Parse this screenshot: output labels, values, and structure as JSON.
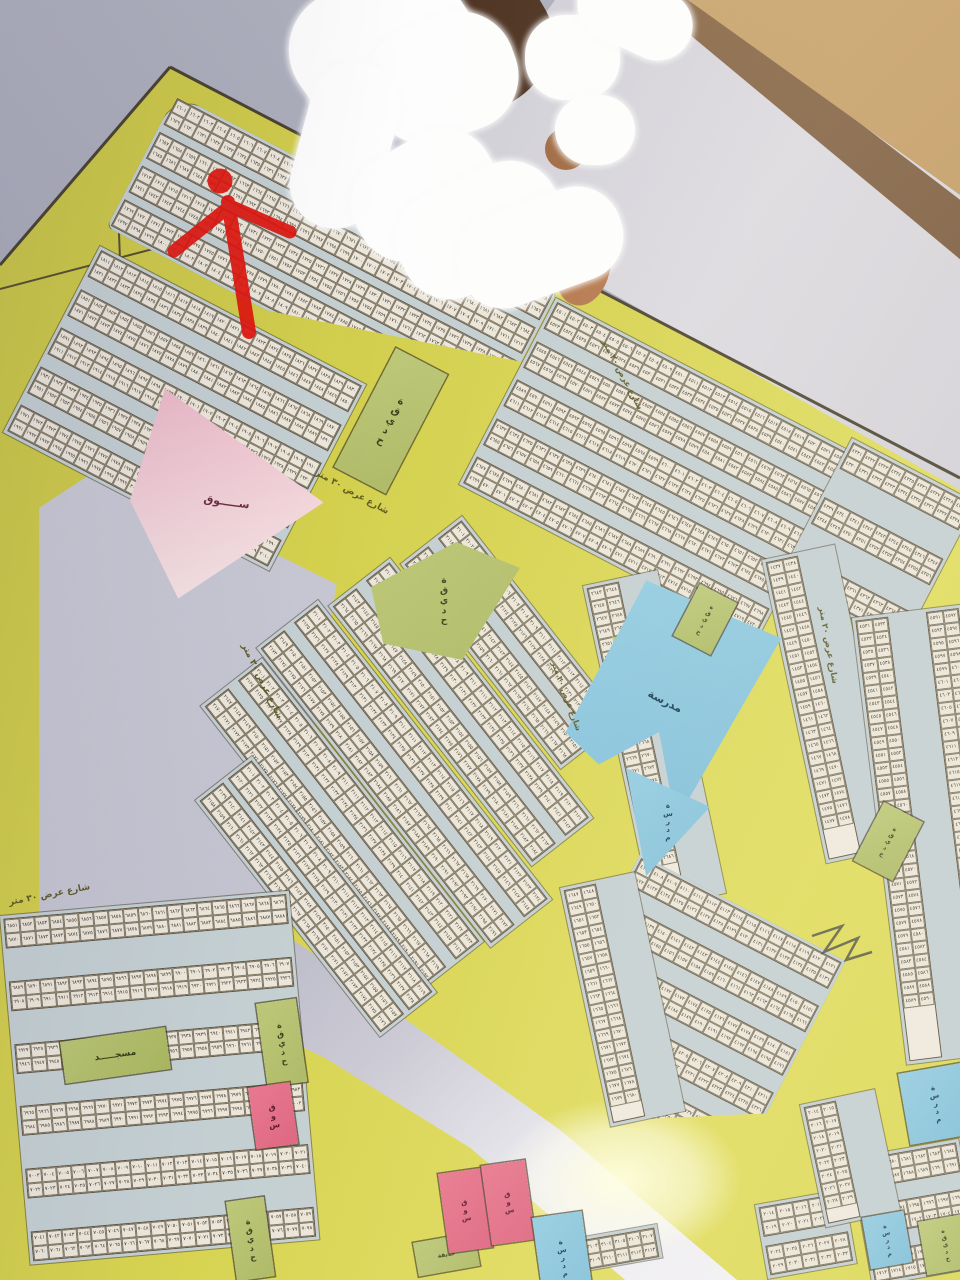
{
  "photo_subject": "wall-mounted land subdivision plot map",
  "arabic_digits": "٠١٢٣٤٥٦٧٨٩",
  "labels": {
    "park": "حديقة",
    "market": "سوق",
    "market_long": "ســـــوق",
    "mosque": "مسجـــــد",
    "school": "مدرسة",
    "street_30": "شارع عرض ٣٠ متر",
    "street_20": "شارع عرض ٢٠ متر",
    "street_15": "شارع عرض ١٥ متر"
  },
  "colors": {
    "map_yellow": "#d6d250",
    "block_street_blue": "#c4cfd2",
    "plot_cell": "#ece6da",
    "park_green": "#b5c16e",
    "market_pink": "#e06c86",
    "school_blue": "#89c4de",
    "empty_lavender": "#c6c6d2",
    "marker_red": "#e0150d",
    "wall_tan": "#c6a26a",
    "wall_gray": "#a9aab8"
  },
  "annotation_marker": {
    "shape": "red dot with hand-drawn arrow pointing to plot",
    "cx": 220,
    "cy": 181
  },
  "plot_number_series": [
    {
      "start": 1601
    },
    {
      "start": 1811
    },
    {
      "start": 4501
    },
    {
      "start": 4321
    },
    {
      "start": 1437
    },
    {
      "start": 2643
    },
    {
      "start": 4107
    },
    {
      "start": 4531
    },
    {
      "start": 2101
    },
    {
      "start": 1647
    },
    {
      "start": 6851
    },
    {
      "start": 3102
    },
    {
      "start": 1678
    },
    {
      "start": 2014
    }
  ],
  "blocks": [
    {
      "x": 176,
      "y": 94,
      "w": 430,
      "h": 150,
      "rot": 27.5,
      "strips": 4,
      "cols": 28,
      "series": 0,
      "radius": "30px 8px 8px 8px",
      "clip": "polygon(0 0,100% 0,100% 52%,42% 100%,0 100%)"
    },
    {
      "x": 100,
      "y": 246,
      "w": 300,
      "h": 210,
      "rot": 27.5,
      "strips": 5,
      "cols": 20,
      "series": 1
    },
    {
      "x": 556,
      "y": 298,
      "w": 336,
      "h": 210,
      "rot": 27.5,
      "strips": 5,
      "cols": 22,
      "series": 2
    },
    {
      "x": 852,
      "y": 438,
      "w": 140,
      "h": 160,
      "rot": 27.5,
      "strips": 3,
      "cols": 9,
      "series": 3
    },
    {
      "x": 762,
      "y": 560,
      "w": 74,
      "h": 310,
      "rot": -12,
      "vert": true,
      "strips": 1,
      "rows": 21,
      "series": 4
    },
    {
      "x": 583,
      "y": 586,
      "w": 76,
      "h": 330,
      "rot": -12,
      "vert": true,
      "strips": 1,
      "rows": 22,
      "series": 5
    },
    {
      "x": 640,
      "y": 854,
      "w": 232,
      "h": 232,
      "rot": 27.5,
      "strips": 5,
      "cols": 15,
      "series": 6,
      "clip": "polygon(0 0,100% 0,100% 74%,55% 100%,26% 74%,0 42%)"
    },
    {
      "x": 852,
      "y": 618,
      "w": 110,
      "h": 450,
      "rot": -7,
      "vert": true,
      "strips": 2,
      "rows": 30,
      "series": 7
    },
    {
      "x": 462,
      "y": 516,
      "w": 260,
      "h": 78,
      "rot": 52,
      "strips": 2,
      "cols": 17,
      "series": 8
    },
    {
      "x": 390,
      "y": 558,
      "w": 330,
      "h": 78,
      "rot": 52,
      "strips": 2,
      "cols": 21,
      "series": 8
    },
    {
      "x": 318,
      "y": 600,
      "w": 380,
      "h": 78,
      "rot": 52,
      "strips": 2,
      "cols": 24,
      "series": 8
    },
    {
      "x": 262,
      "y": 658,
      "w": 360,
      "h": 78,
      "rot": 52,
      "strips": 2,
      "cols": 23,
      "series": 8
    },
    {
      "x": 252,
      "y": 756,
      "w": 300,
      "h": 72,
      "rot": 52,
      "strips": 2,
      "cols": 19,
      "series": 8
    },
    {
      "x": 560,
      "y": 888,
      "w": 76,
      "h": 244,
      "rot": -12,
      "vert": true,
      "strips": 1,
      "rows": 17,
      "series": 9
    },
    {
      "x": 0,
      "y": 916,
      "w": 290,
      "h": 350,
      "rot": -5,
      "strips": 6,
      "cols": 19,
      "series": 10
    },
    {
      "x": 566,
      "y": 1240,
      "w": 92,
      "h": 34,
      "rot": -10,
      "strips": 1,
      "cols": 6,
      "series": 11
    },
    {
      "x": 850,
      "y": 1158,
      "w": 110,
      "h": 130,
      "rot": -10,
      "strips": 3,
      "cols": 7,
      "series": 12
    },
    {
      "x": 755,
      "y": 1205,
      "w": 90,
      "h": 75,
      "rot": -10,
      "strips": 2,
      "cols": 5,
      "series": 13
    },
    {
      "x": 800,
      "y": 1105,
      "w": 76,
      "h": 125,
      "rot": -12,
      "vert": true,
      "strips": 1,
      "rows": 8,
      "series": 13
    }
  ],
  "areas": [
    {
      "kind": "park",
      "label": "park",
      "x": 396,
      "y": 348,
      "w": 58,
      "h": 134,
      "rot": 27.5,
      "fs": 10,
      "v": true
    },
    {
      "kind": "markettri",
      "label": "market_long",
      "x": 146,
      "y": 386,
      "w": 192,
      "h": 206,
      "rot": 8,
      "fs": 11,
      "clip": "polygon(10% 0,100% 44%,32% 100%,0 56%)"
    },
    {
      "kind": "park",
      "label": "park",
      "x": 368,
      "y": 542,
      "w": 152,
      "h": 118,
      "rot": 0,
      "fs": 9,
      "v": true,
      "clip": "polygon(2% 38%,58% 0,100% 22%,62% 100%,10% 86%)"
    },
    {
      "kind": "park",
      "label": "park",
      "x": 612,
      "y": 636,
      "w": 62,
      "h": 100,
      "rot": 0,
      "fs": 7,
      "v": true,
      "clip": "polygon(0 0,100% 30%,30% 100%)"
    },
    {
      "kind": "school",
      "label": "school",
      "x": 650,
      "y": 570,
      "w": 148,
      "h": 218,
      "rot": 27.5,
      "fs": 11,
      "v": false,
      "clip": "polygon(1% 5%,100% 0,94% 97%,56% 64%,30% 90%,0 84%)"
    },
    {
      "kind": "school",
      "label": "school",
      "x": 626,
      "y": 768,
      "w": 84,
      "h": 108,
      "rot": 0,
      "fs": 7,
      "v": true,
      "clip": "polygon(0 0,100% 36%,24% 100%)"
    },
    {
      "kind": "park",
      "label": "park",
      "x": 700,
      "y": 584,
      "w": 42,
      "h": 58,
      "rot": 27.5,
      "fs": 6,
      "v": true
    },
    {
      "kind": "park",
      "label": "park",
      "x": 884,
      "y": 802,
      "w": 44,
      "h": 66,
      "rot": 27.5,
      "fs": 6,
      "v": true
    },
    {
      "kind": "mosque",
      "label": "mosque",
      "x": 60,
      "y": 1042,
      "w": 106,
      "h": 42,
      "rot": -8,
      "fs": 9,
      "v": false
    },
    {
      "kind": "park",
      "label": "park",
      "x": 256,
      "y": 1004,
      "w": 40,
      "h": 84,
      "rot": -8,
      "fs": 8,
      "v": true
    },
    {
      "kind": "market",
      "label": "market",
      "x": 248,
      "y": 1088,
      "w": 42,
      "h": 62,
      "rot": -8,
      "fs": 8,
      "v": true
    },
    {
      "kind": "park",
      "label": "park",
      "x": 226,
      "y": 1202,
      "w": 38,
      "h": 80,
      "rot": -8,
      "fs": 8,
      "v": true
    },
    {
      "kind": "park",
      "label": "park",
      "x": 413,
      "y": 1243,
      "w": 62,
      "h": 34,
      "rot": -10,
      "fs": 6,
      "v": false
    },
    {
      "kind": "market",
      "label": "market",
      "x": 438,
      "y": 1174,
      "w": 44,
      "h": 80,
      "rot": -8,
      "fs": 7,
      "v": true
    },
    {
      "kind": "market",
      "label": "market",
      "x": 481,
      "y": 1166,
      "w": 44,
      "h": 80,
      "rot": -8,
      "fs": 7,
      "v": true
    },
    {
      "kind": "school",
      "label": "school",
      "x": 532,
      "y": 1218,
      "w": 50,
      "h": 88,
      "rot": -8,
      "fs": 7,
      "v": true
    },
    {
      "kind": "school",
      "label": "school",
      "x": 898,
      "y": 1074,
      "w": 64,
      "h": 72,
      "rot": -10,
      "fs": 7,
      "v": true
    },
    {
      "kind": "school",
      "label": "school",
      "x": 862,
      "y": 1218,
      "w": 42,
      "h": 52,
      "rot": -10,
      "fs": 6,
      "v": true
    },
    {
      "kind": "park",
      "label": "park",
      "x": 918,
      "y": 1222,
      "w": 46,
      "h": 54,
      "rot": -10,
      "fs": 6,
      "v": true
    }
  ],
  "roads": [
    {
      "label": "street_30",
      "x": 248,
      "y": 642,
      "rot": 64,
      "fs": 9
    },
    {
      "label": "street_20",
      "x": 608,
      "y": 338,
      "rot": 62,
      "fs": 8.5
    },
    {
      "label": "street_20",
      "x": 826,
      "y": 606,
      "rot": 80,
      "fs": 8.5
    },
    {
      "label": "street_30",
      "x": 318,
      "y": 468,
      "rot": 29,
      "fs": 9
    },
    {
      "label": "street_30",
      "x": 8,
      "y": 898,
      "rot": -11,
      "fs": 9
    },
    {
      "label": "street_20",
      "x": 558,
      "y": 660,
      "rot": 70,
      "fs": 8
    }
  ],
  "empties": [
    {
      "x": 36,
      "y": 462,
      "w": 310,
      "h": 510,
      "clip": "polygon(21% 1%,97% 24%,76% 99%,1% 91%,1% 9%)"
    }
  ],
  "white_road": {
    "x": 224,
    "y": 898,
    "w": 513,
    "h": 382,
    "clip": "polygon(1.2% 0,18.7% 15.7%,65.5% 60.7%,100% 100%,78.2% 100%,48% 65.4%,19.7% 41.9%,0 29.3%)"
  },
  "glare_spot": {
    "x": 500,
    "y": 1100,
    "w": 240,
    "h": 160
  }
}
